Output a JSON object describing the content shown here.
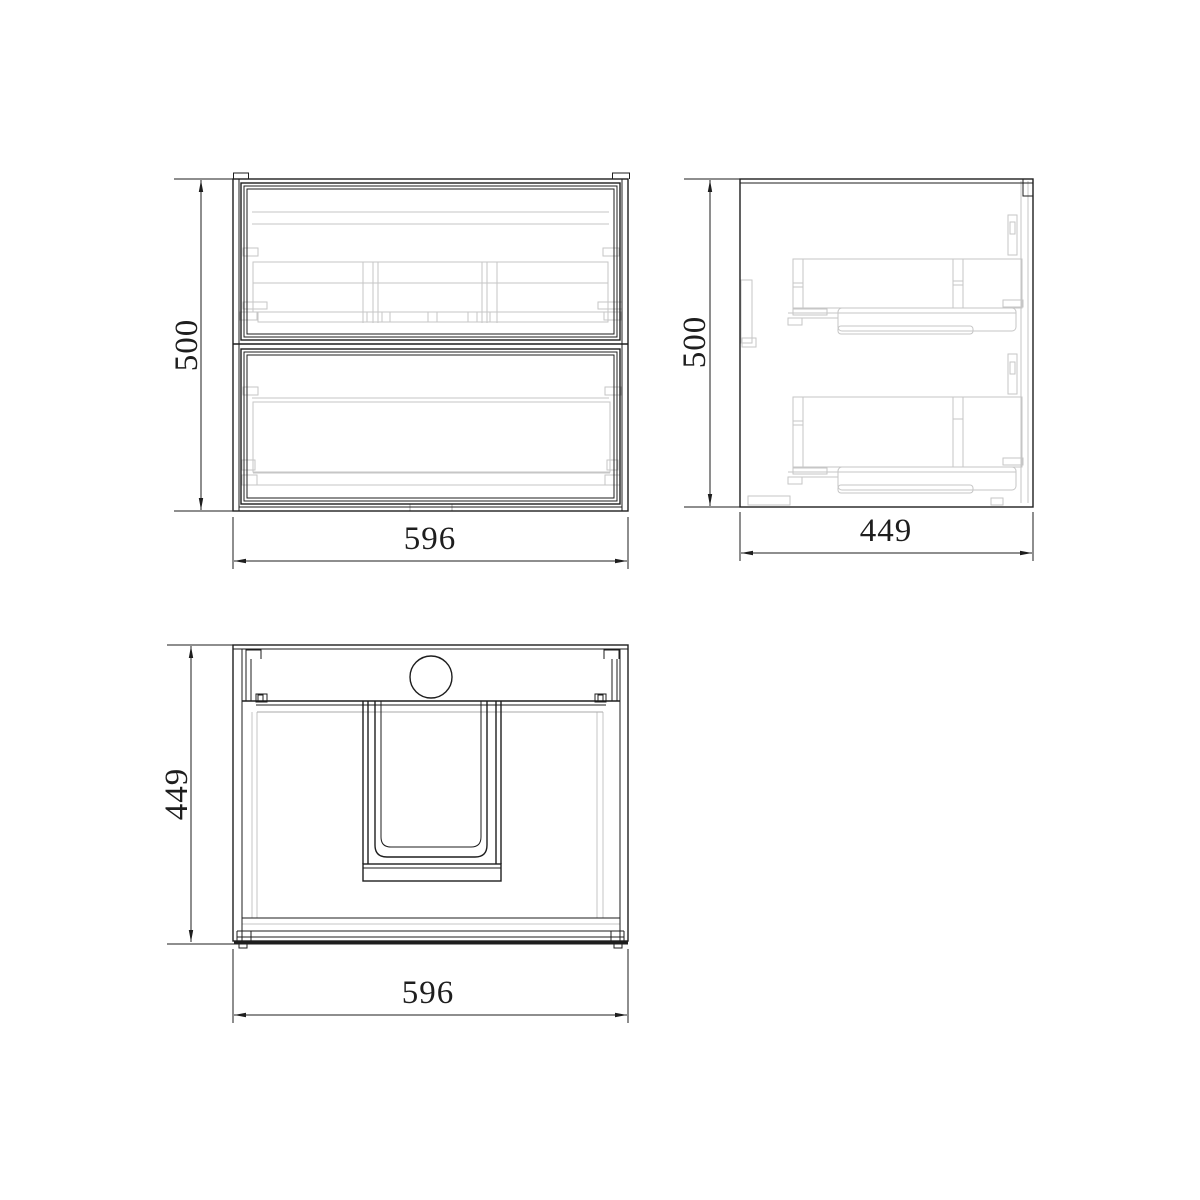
{
  "drawing": {
    "type": "orthographic-technical-drawing",
    "subject": "wall-hung two-drawer vanity cabinet with integrated basin",
    "colors": {
      "line": "#1e1e1e",
      "hidden": "#c6c6c6",
      "hidden_dark": "#a9a9a9",
      "background": "#ffffff"
    },
    "views": {
      "front": {
        "height_label": "500",
        "width_label": "596"
      },
      "side": {
        "height_label": "500",
        "width_label": "449"
      },
      "top": {
        "depth_label": "449",
        "width_label": "596"
      }
    }
  }
}
